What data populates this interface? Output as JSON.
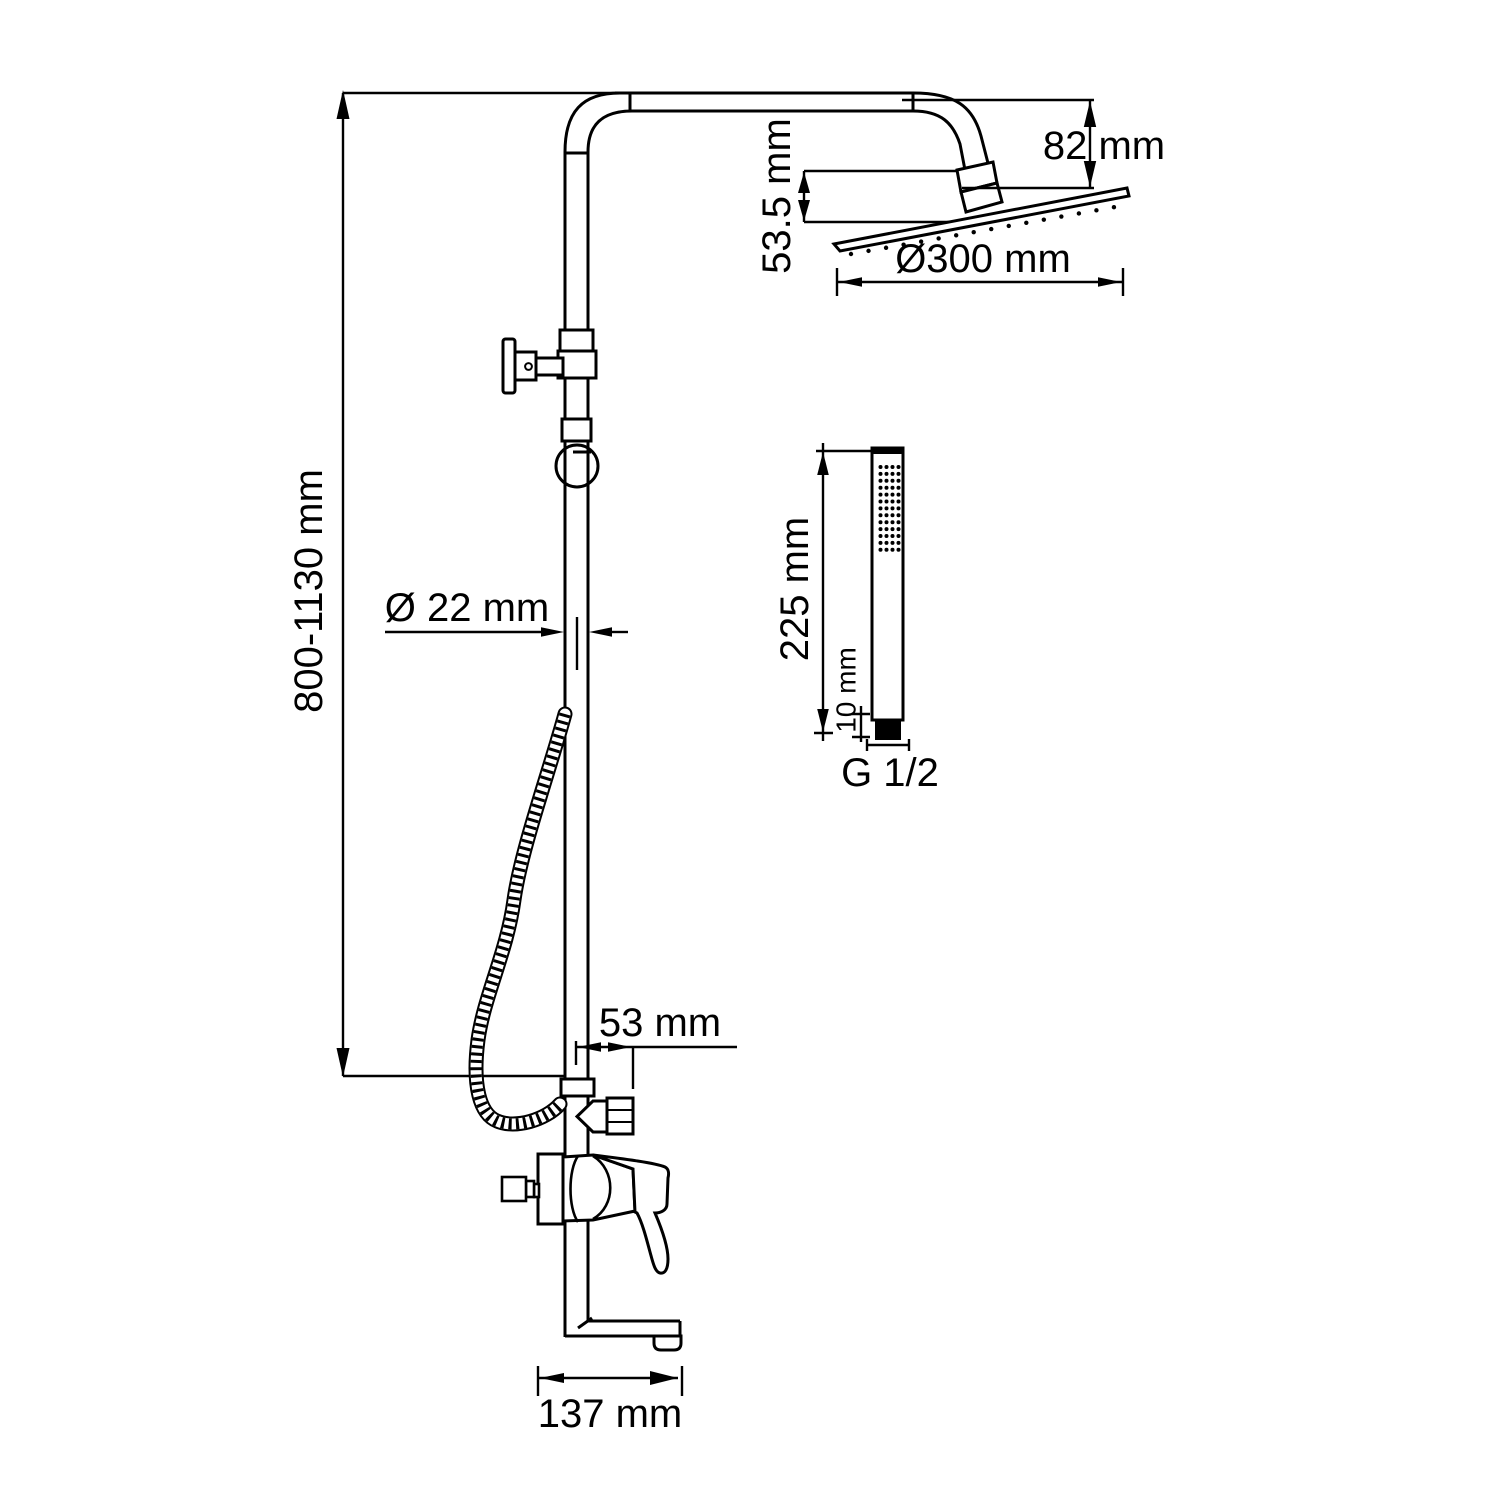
{
  "title": "Shower column technical drawing",
  "dimensions": {
    "overall_height": "800-1130 mm",
    "head_arm_drop": "82 mm",
    "head_tilt_drop": "53.5 mm",
    "head_diameter": "Ø300 mm",
    "pipe_diameter": "Ø 22 mm",
    "handshower_length": "225 mm",
    "handshower_thread_length": "10 mm",
    "handshower_thread": "G 1/2",
    "outlet_offset": "53 mm",
    "spout_reach": "137 mm"
  },
  "colors": {
    "line": "#000000",
    "background": "#ffffff"
  }
}
